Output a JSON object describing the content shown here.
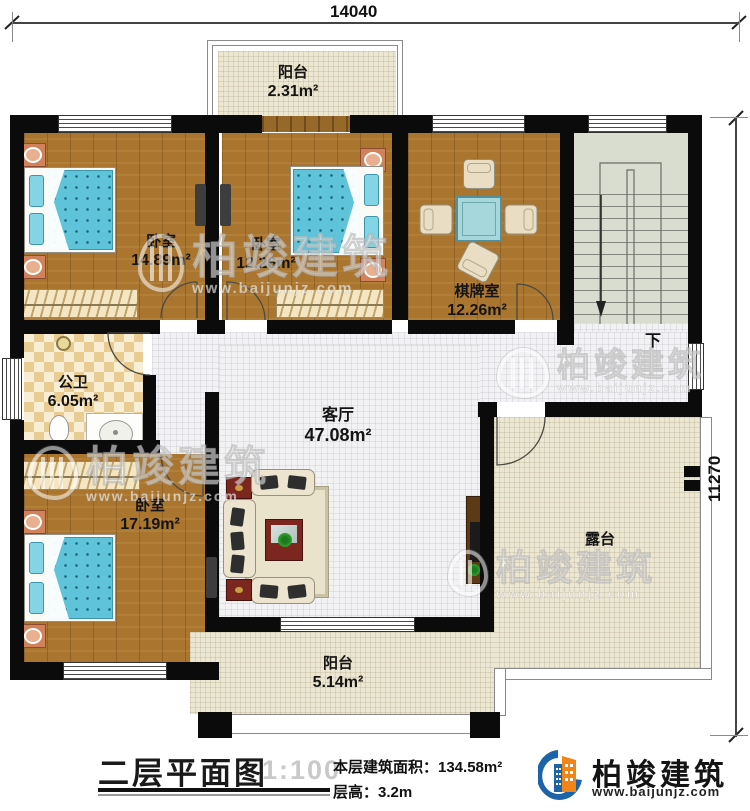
{
  "dimensions": {
    "top": "14040",
    "right": "11270"
  },
  "rooms": {
    "balcony_top": {
      "name": "阳台",
      "area": "2.31m²"
    },
    "bedroom1": {
      "name": "卧室",
      "area": "14.89m²"
    },
    "bedroom2": {
      "name": "卧室",
      "area": "12.26m²"
    },
    "game_room": {
      "name": "棋牌室",
      "area": "12.26m²"
    },
    "bathroom": {
      "name": "公卫",
      "area": "6.05m²"
    },
    "living_room": {
      "name": "客厅",
      "area": "47.08m²"
    },
    "bedroom3": {
      "name": "卧室",
      "area": "17.19m²"
    },
    "terrace": {
      "name": "露台"
    },
    "balcony_bottom": {
      "name": "阳台",
      "area": "5.14m²"
    }
  },
  "stairs": {
    "down_label": "下"
  },
  "title_block": {
    "title": "二层平面图",
    "scale": "1:100",
    "area_line": "本层建筑面积：134.58m²",
    "floor_height_line": "层高：3.2m"
  },
  "brand": {
    "name": "柏竣建筑",
    "website": "www.baijunjz.com"
  },
  "watermark": {
    "name": "柏竣建筑",
    "website": "www.baijunjz.com"
  },
  "colors": {
    "wall": "#0b0b0b",
    "wood_floor": "#a9752f",
    "tile_white": "#f2f2f4",
    "tile_cream": "#ece7d2",
    "bathroom_tile": "#e9cc92",
    "stair_floor": "#d8ddd0",
    "bed_blue": "#5fc4d9",
    "brand_blue": "#1c63a8",
    "brand_orange": "#f08519"
  }
}
